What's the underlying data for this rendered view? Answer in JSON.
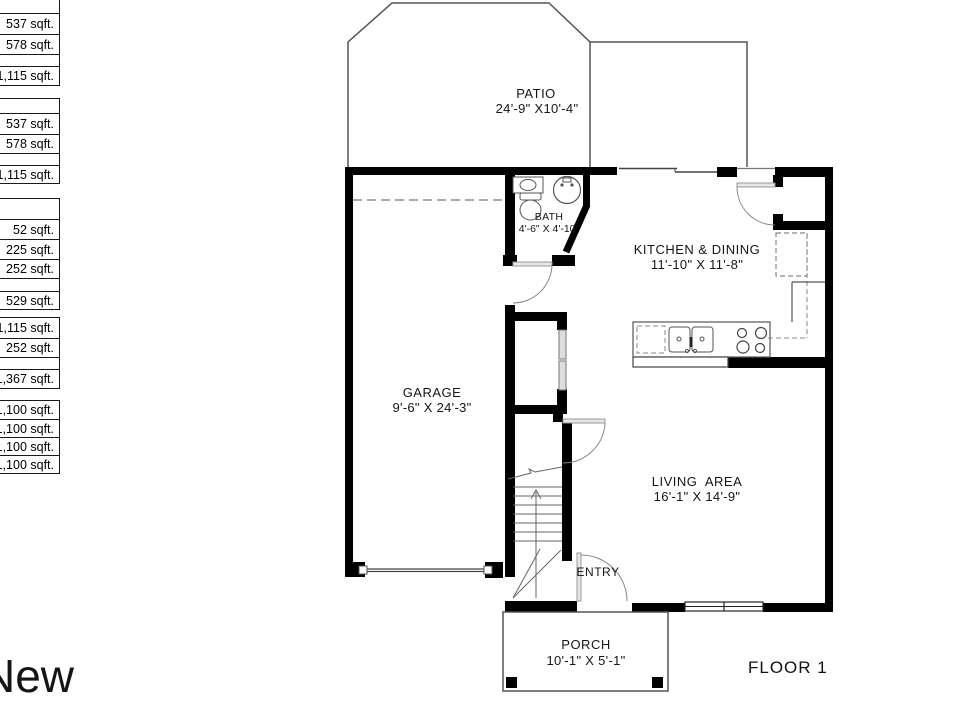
{
  "floor_label": "FLOOR 1",
  "watermark_text": "New",
  "rooms": {
    "patio": {
      "name": "PATIO",
      "dims": "24'-9\" X10'-4\""
    },
    "bath": {
      "name": "BATH",
      "dims": "4'-6\" X 4'-10\""
    },
    "kitchen_dining": {
      "name": "KITCHEN & DINING",
      "dims": "11'-10\" X 11'-8\""
    },
    "garage": {
      "name": "GARAGE",
      "dims": "9'-6\" X 24'-3\""
    },
    "living_area": {
      "name": "LIVING  AREA",
      "dims": "16'-1\" X 14'-9\""
    },
    "entry": {
      "name": "ENTRY"
    },
    "porch": {
      "name": "PORCH",
      "dims": "10'-1\" X 5'-1\""
    }
  },
  "area_tables": [
    {
      "rows": [
        "",
        "537 sqft.",
        "578 sqft.",
        "",
        "1,115 sqft."
      ]
    },
    {
      "rows": [
        "",
        "537 sqft.",
        "578 sqft.",
        "",
        "1,115 sqft."
      ]
    },
    {
      "rows": [
        "",
        "52 sqft.",
        "225 sqft.",
        "252 sqft.",
        "",
        "529 sqft."
      ]
    },
    {
      "rows": [
        "1,115 sqft.",
        "252 sqft.",
        "",
        "1,367 sqft."
      ]
    },
    {
      "rows": [
        "1,100 sqft.",
        "1,100 sqft.",
        "1,100 sqft.",
        "1,100 sqft."
      ]
    }
  ],
  "colors": {
    "wall": "#000000",
    "thin_line": "#555555",
    "dashed_line": "#888888",
    "door_leaf": "#e6e6e6"
  }
}
